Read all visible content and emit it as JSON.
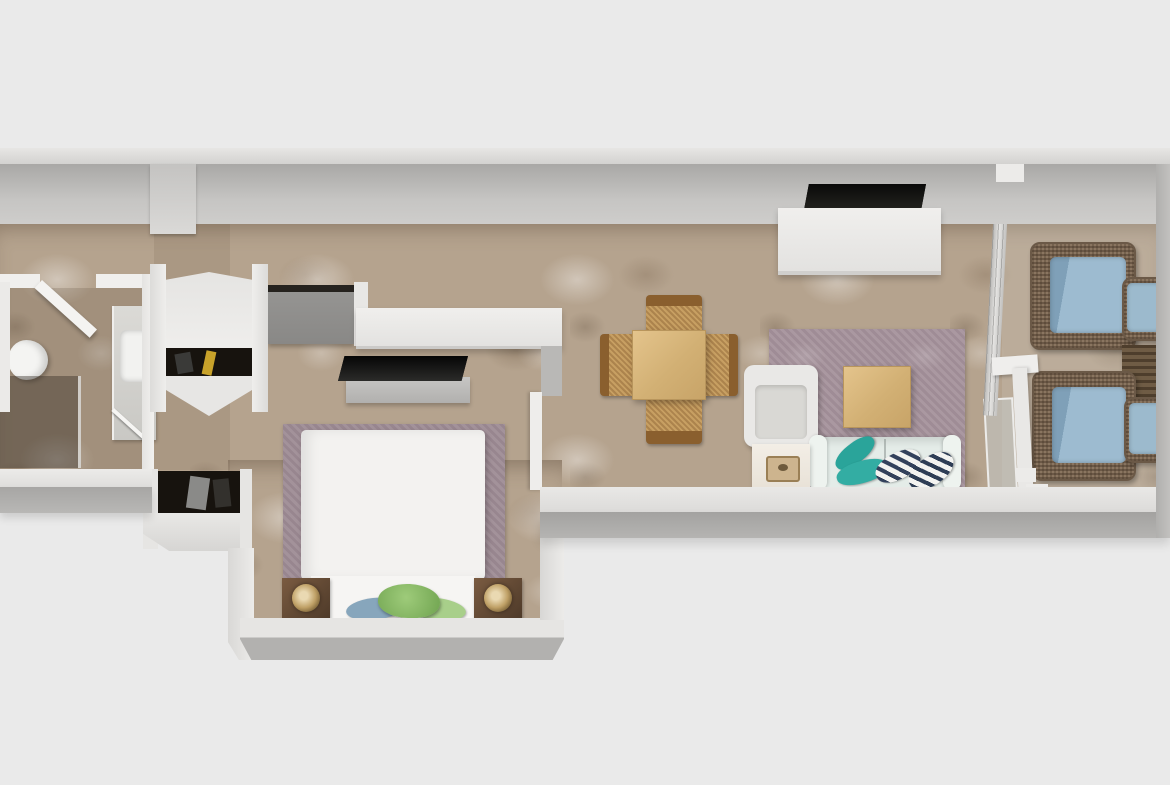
{
  "scene": {
    "type": "3d-floor-plan-top-view",
    "description": "Top-down 3D render of a narrow one-bedroom apartment: bathroom, entry hall with wardrobes, bedroom, open living-dining area and a balcony with wicker lounge furniture",
    "background_color": "#eaeaea"
  },
  "palette": {
    "background": "#eaeaea",
    "wall_top": "#ecebe9",
    "wall_face": "#b5b4b2",
    "floor_base": "#b5a38e",
    "rug_mauve": "#9e8c95",
    "duvet_white": "#f3f2f0",
    "wood_light": "#d9b87c",
    "rattan_seat": "#c79f62",
    "rattan_back": "#8a5f2e",
    "wicker_brown": "#8a7560",
    "cushion_blue": "#9cbacd",
    "pillow_teal": "#2aa49a",
    "pillow_stripe_navy": "#33415c",
    "pillow_green": "#8fc26c",
    "pillow_blue_gray": "#87a6bc",
    "nightstand_brown": "#6b5340",
    "lamp_gold": "#c3a368",
    "tv_black": "#0d0d0b",
    "cabinet_gray": "#8e8d8b",
    "closet_dark": "#17130e",
    "sofa_pale": "#e4ece8",
    "glass": "#bcc2c2"
  },
  "rooms": [
    {
      "name": "bathroom",
      "furniture": [
        "toilet",
        "vanity-with-sink",
        "walk-in-shower",
        "open-door",
        "floor-squeegee"
      ]
    },
    {
      "name": "entry-hall",
      "furniture": [
        "curved-door-wardrobe",
        "gray-top-cabinet",
        "lower-closet-with-clothes"
      ]
    },
    {
      "name": "bedroom",
      "furniture": [
        "double-bed-white-duvet",
        "mauve-area-rug",
        "nightstand-left",
        "nightstand-right",
        "table-lamp-left",
        "table-lamp-right",
        "tv-on-low-stand",
        "long-white-console-desk",
        "green-and-blue-throw-pillows"
      ]
    },
    {
      "name": "living-dining-room",
      "furniture": [
        "square-dining-table",
        "four-rattan-chairs",
        "wall-mounted-tv",
        "white-sideboard",
        "mauve-area-rug",
        "wood-coffee-table",
        "white-armchair",
        "pale-sofa-with-teal-and-striped-pillows",
        "side-table-with-tray"
      ]
    },
    {
      "name": "balcony",
      "furniture": [
        "wicker-armchair-top",
        "wicker-armchair-bottom",
        "wicker-ottoman-top",
        "wicker-ottoman-bottom",
        "slatted-side-table",
        "glass-railing",
        "sliding-glass-door-frame"
      ]
    }
  ]
}
